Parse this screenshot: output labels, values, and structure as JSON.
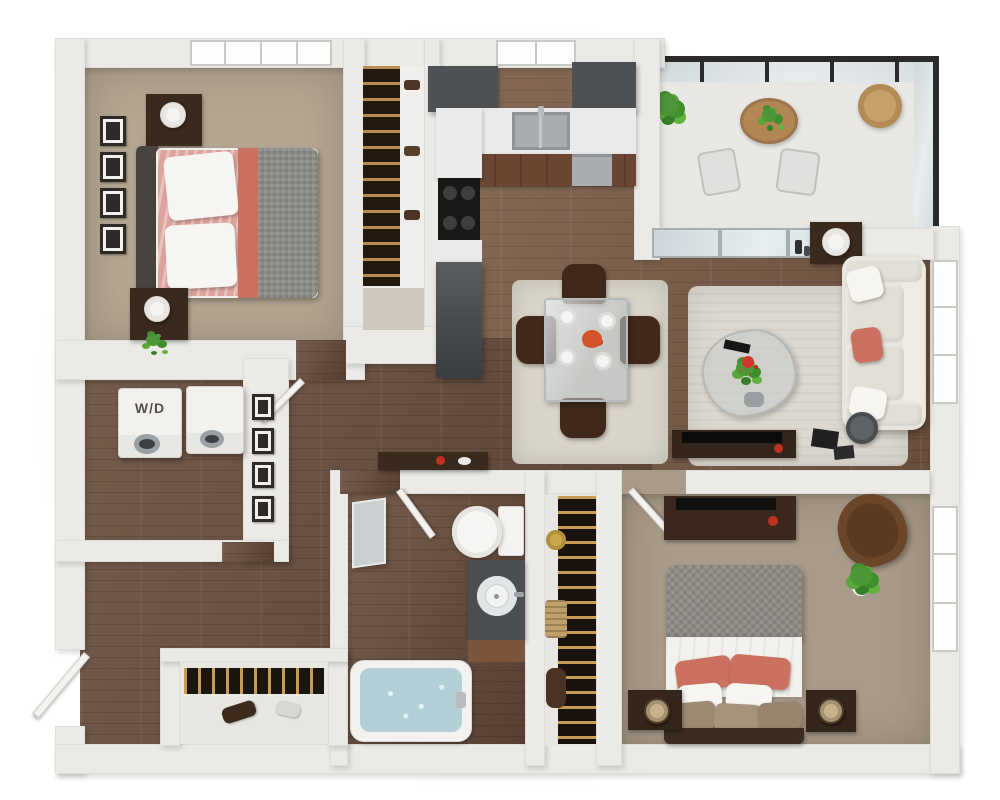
{
  "title": "3D apartment floor plan render, one-level unit, top-down view",
  "labels": {
    "washer_dryer": "W/D"
  },
  "palette": {
    "wall": "#eceae7",
    "wall_edge": "#d6d4d0",
    "wood": "#7b5c46",
    "wood_dark": "#6b5040",
    "carpet1": "#b5a693",
    "carpet2": "#a99b8a",
    "cab_dark": "#4e5154",
    "counter": "#e9eae9",
    "cab_wood": "#6b4733",
    "coral": "#cb7160",
    "duvet": "#8f8d88",
    "sofa": "#e7e4dd",
    "rug": "#dcd8cf",
    "rug_dining": "#d9d4c9",
    "green": "#4c9638",
    "water": "#b2d0d6",
    "glass1": "#d3dde0",
    "frame_dark": "#2b2b2b",
    "furn_dark": "#3a2a1d",
    "appliance_white": "#f2f1ee"
  },
  "objects": {
    "bedroom1": [
      "queen-bed-coral-gray",
      "nightstand-lamp-x2",
      "wall-frames-x4",
      "window",
      "reach-in-closet"
    ],
    "kitchen": [
      "upper-cabinets",
      "sink",
      "window",
      "cooktop",
      "dishwasher",
      "tall-cabinet"
    ],
    "balcony": [
      "glass-railing",
      "round-table",
      "potted-plants",
      "wicker-chair",
      "patio-chairs"
    ],
    "living_room": [
      "sliding-glass-door",
      "sofa-cream",
      "coral-pillow",
      "area-rug",
      "coffee-table-flowers",
      "tv-console",
      "floor-lamp",
      "side-table-lamp",
      "window"
    ],
    "dining": [
      "glass-table",
      "chairs-x4",
      "place-settings-x4",
      "centerpiece-flowers",
      "rug"
    ],
    "laundry": [
      "washer",
      "dryer",
      "wd-label"
    ],
    "bathroom": [
      "toilet",
      "vanity-round-sink",
      "bathtub-water",
      "leaning-mirror",
      "door"
    ],
    "walk_in_closet": [
      "hanging-clothes",
      "hat-box-gold",
      "basket",
      "storage-cylinder"
    ],
    "bedroom2": [
      "queen-bed-gray-coral",
      "nightstand-lamp-x2",
      "media-console-tv",
      "armchair-brown",
      "potted-plant",
      "window",
      "door"
    ],
    "entry": [
      "front-door-open",
      "entry-closet-rod",
      "shoes"
    ]
  }
}
